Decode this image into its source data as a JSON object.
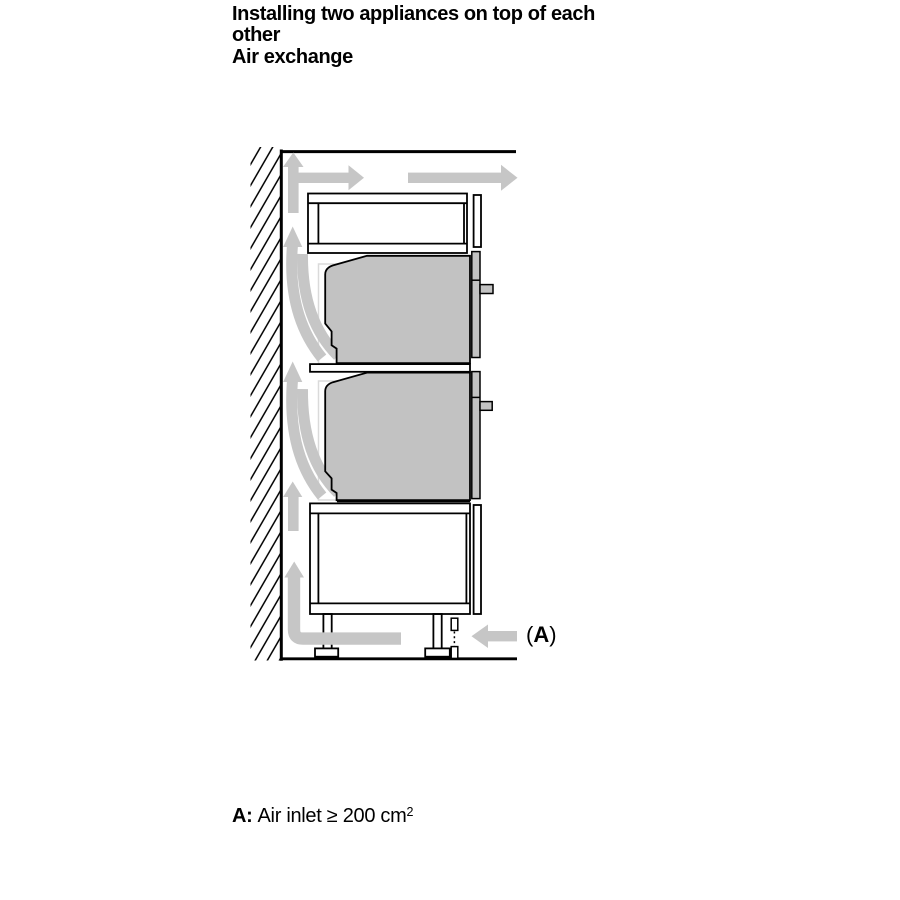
{
  "page": {
    "background": "#ffffff"
  },
  "header": {
    "title_lines": [
      "Installing two appliances on top of each",
      "other",
      "Air exchange"
    ]
  },
  "caption": {
    "label": "A:",
    "text": "Air inlet ≥ 200 cm",
    "superscript": "2"
  },
  "diagram": {
    "label_a": {
      "open": "(",
      "letter": "A",
      "close": ")"
    },
    "colors": {
      "arrow": "#c6c6c6",
      "appliance_fill": "#c2c2c2",
      "outline": "#000000",
      "cabinet_fill": "#ffffff",
      "niche_outline": "#dadada"
    },
    "arrows": [
      {
        "name": "airflow-up-right-arrow",
        "meaning": "air rising along wall, branching out above top cabinet"
      },
      {
        "name": "airflow-exhaust-arrow",
        "meaning": "air flowing out over top cabinet"
      },
      {
        "name": "airflow-curved-arrows-upper",
        "meaning": "air from behind upper appliance curving up the wall"
      },
      {
        "name": "airflow-curved-arrows-lower",
        "meaning": "air from behind lower appliance curving up the wall"
      },
      {
        "name": "airflow-up-arrow",
        "meaning": "air rising along wall behind base cabinet"
      },
      {
        "name": "airflow-bottom-elbow-arrow",
        "meaning": "inlet air turning upward behind plinth"
      },
      {
        "name": "air-inlet-arrow",
        "meaning": "air entering at plinth opening A"
      }
    ]
  }
}
